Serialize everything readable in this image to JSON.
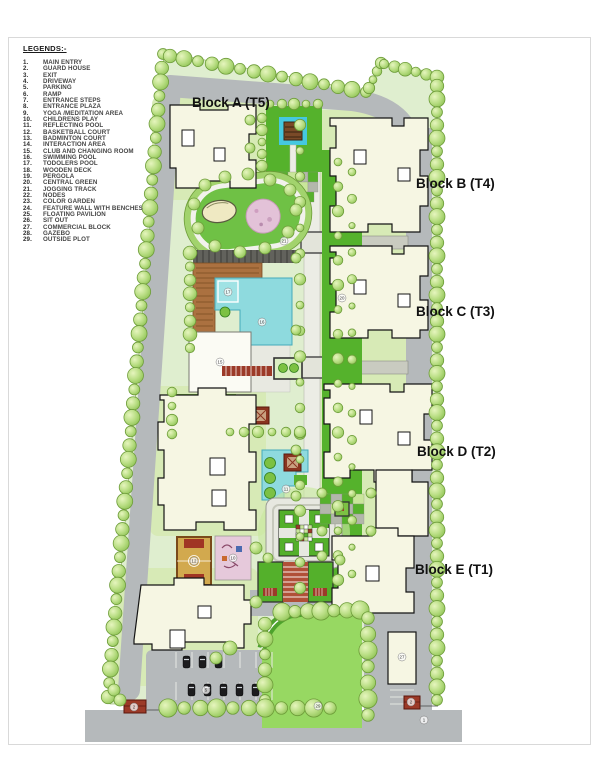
{
  "legend": {
    "title": "LEGENDS:-",
    "items": [
      {
        "num": "1.",
        "label": "MAIN ENTRY"
      },
      {
        "num": "2.",
        "label": "GUARD HOUSE"
      },
      {
        "num": "3.",
        "label": "EXIT"
      },
      {
        "num": "4.",
        "label": "DRIVEWAY"
      },
      {
        "num": "5.",
        "label": "PARKING"
      },
      {
        "num": "6.",
        "label": "RAMP"
      },
      {
        "num": "7.",
        "label": "ENTRANCE STEPS"
      },
      {
        "num": "8.",
        "label": "ENTRANCE PLAZA"
      },
      {
        "num": "9.",
        "label": "YOGA /MEDITATION AREA"
      },
      {
        "num": "10.",
        "label": "CHILDRENS PLAY"
      },
      {
        "num": "11.",
        "label": "REFLECTING POOL"
      },
      {
        "num": "12.",
        "label": "BASKETBALL COURT"
      },
      {
        "num": "13.",
        "label": "BADMINTON COURT"
      },
      {
        "num": "14.",
        "label": "INTERACTION AREA"
      },
      {
        "num": "15.",
        "label": "CLUB AND CHANGING ROOM"
      },
      {
        "num": "16.",
        "label": "SWIMMING POOL"
      },
      {
        "num": "17.",
        "label": "TODOLERS POOL"
      },
      {
        "num": "18.",
        "label": "WOODEN DECK"
      },
      {
        "num": "19.",
        "label": "PERGOLA"
      },
      {
        "num": "20.",
        "label": "CENTRAL GREEN"
      },
      {
        "num": "21.",
        "label": "JOGGING TRACK"
      },
      {
        "num": "22.",
        "label": "NODES"
      },
      {
        "num": "23.",
        "label": "COLOR GARDEN"
      },
      {
        "num": "24.",
        "label": "FEATURE WALL WITH BENCHES"
      },
      {
        "num": "25.",
        "label": "FLOATING PAVILION"
      },
      {
        "num": "26.",
        "label": "SIT OUT"
      },
      {
        "num": "27.",
        "label": "COMMERCIAL BLOCK"
      },
      {
        "num": "28.",
        "label": "GAZEBO"
      },
      {
        "num": "29.",
        "label": "OUTSIDE PLOT"
      }
    ]
  },
  "blocks": [
    {
      "label": "Block A (T5)",
      "x": 192,
      "y": 107
    },
    {
      "label": "Block B (T4)",
      "x": 416,
      "y": 188
    },
    {
      "label": "Block C (T3)",
      "x": 416,
      "y": 316
    },
    {
      "label": "Block D (T2)",
      "x": 417,
      "y": 456
    },
    {
      "label": "Block E (T1)",
      "x": 415,
      "y": 574
    }
  ],
  "map_markers": [
    {
      "label": "21",
      "x": 284,
      "y": 241
    },
    {
      "label": "16",
      "x": 262,
      "y": 322
    },
    {
      "label": "17",
      "x": 228,
      "y": 292
    },
    {
      "label": "15",
      "x": 220,
      "y": 362
    },
    {
      "label": "20",
      "x": 342,
      "y": 298
    },
    {
      "label": "11",
      "x": 286,
      "y": 489
    },
    {
      "label": "12",
      "x": 194,
      "y": 561
    },
    {
      "label": "10",
      "x": 233,
      "y": 558
    },
    {
      "label": "27",
      "x": 402,
      "y": 657
    },
    {
      "label": "29",
      "x": 318,
      "y": 706
    },
    {
      "label": "5",
      "x": 206,
      "y": 690
    },
    {
      "label": "2",
      "x": 134,
      "y": 707
    },
    {
      "label": "2",
      "x": 411,
      "y": 702
    },
    {
      "label": "1",
      "x": 424,
      "y": 720
    }
  ],
  "colors": {
    "site_base": "#dfeecf",
    "building_pad": "#d7eab6",
    "lawn": "#55b22c",
    "outside_lawn": "#97d862",
    "road": "#b5b9bb",
    "building": "#f6f6e3",
    "pool": "#8edade",
    "deck": "#ab7140",
    "play_pink": "#e6c9db",
    "court_tan": "#d2a94e",
    "accent_red": "#9c3a28",
    "cyan_frame": "#45c8e0"
  }
}
